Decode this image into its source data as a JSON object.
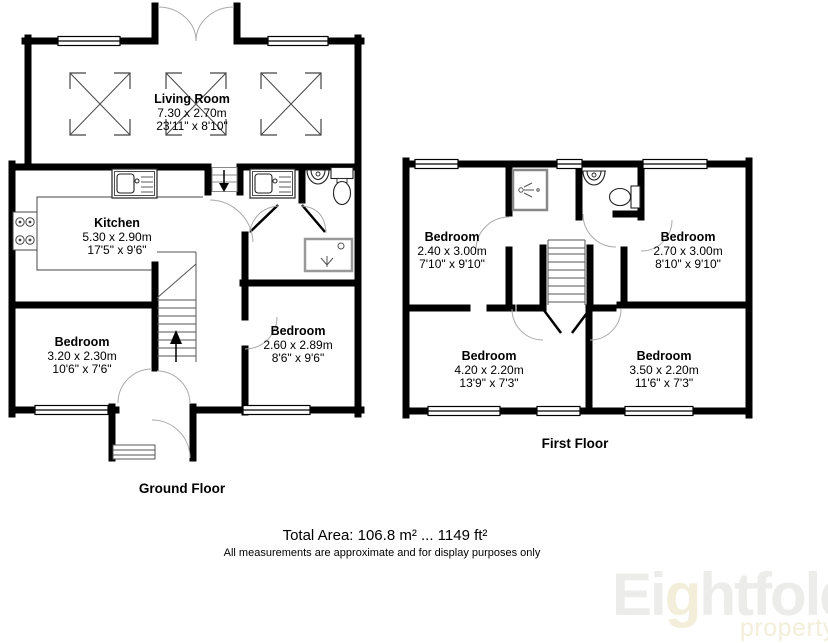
{
  "ground_floor": {
    "label": "Ground Floor",
    "rooms": {
      "living_room": {
        "name": "Living Room",
        "size_m": "7.30 x 2.70m",
        "size_ft": "23'11\" x 8'10\""
      },
      "kitchen": {
        "name": "Kitchen",
        "size_m": "5.30 x 2.90m",
        "size_ft": "17'5\" x 9'6\""
      },
      "bedroom_left": {
        "name": "Bedroom",
        "size_m": "3.20 x 2.30m",
        "size_ft": "10'6\" x 7'6\""
      },
      "bedroom_right": {
        "name": "Bedroom",
        "size_m": "2.60 x 2.89m",
        "size_ft": "8'6\" x 9'6\""
      }
    },
    "fixtures": [
      "kitchen-sink",
      "utility-sink",
      "hob",
      "basin",
      "toilet",
      "shower-tray",
      "stairs-up",
      "steps-down",
      "skylight",
      "skylight",
      "skylight",
      "french-doors",
      "front-door-step"
    ]
  },
  "first_floor": {
    "label": "First Floor",
    "rooms": {
      "bedroom_top_left": {
        "name": "Bedroom",
        "size_m": "2.40 x 3.00m",
        "size_ft": "7'10\" x 9'10\""
      },
      "bedroom_top_right": {
        "name": "Bedroom",
        "size_m": "2.70 x 3.00m",
        "size_ft": "8'10\" x 9'10\""
      },
      "bedroom_bottom_left": {
        "name": "Bedroom",
        "size_m": "4.20 x 2.20m",
        "size_ft": "13'9\" x 7'3\""
      },
      "bedroom_bottom_right": {
        "name": "Bedroom",
        "size_m": "3.50 x 2.20m",
        "size_ft": "11'6\" x 7'3\""
      }
    },
    "fixtures": [
      "shower-cubicle",
      "basin",
      "toilet",
      "stairs"
    ]
  },
  "footer": {
    "total_area": "Total Area: 106.8 m² ... 1149 ft²",
    "disclaimer": "All measurements are approximate and for display purposes only"
  },
  "logo": {
    "brand_prefix": "Ei",
    "brand_accent": "g",
    "brand_suffix": "htfold",
    "tagline": "property"
  },
  "colors": {
    "wall": "#000000",
    "door_arc": "#aaaaaa",
    "fixture_line": "#444444",
    "logo_gray": "#ececea",
    "logo_cream": "#f3eed9"
  }
}
